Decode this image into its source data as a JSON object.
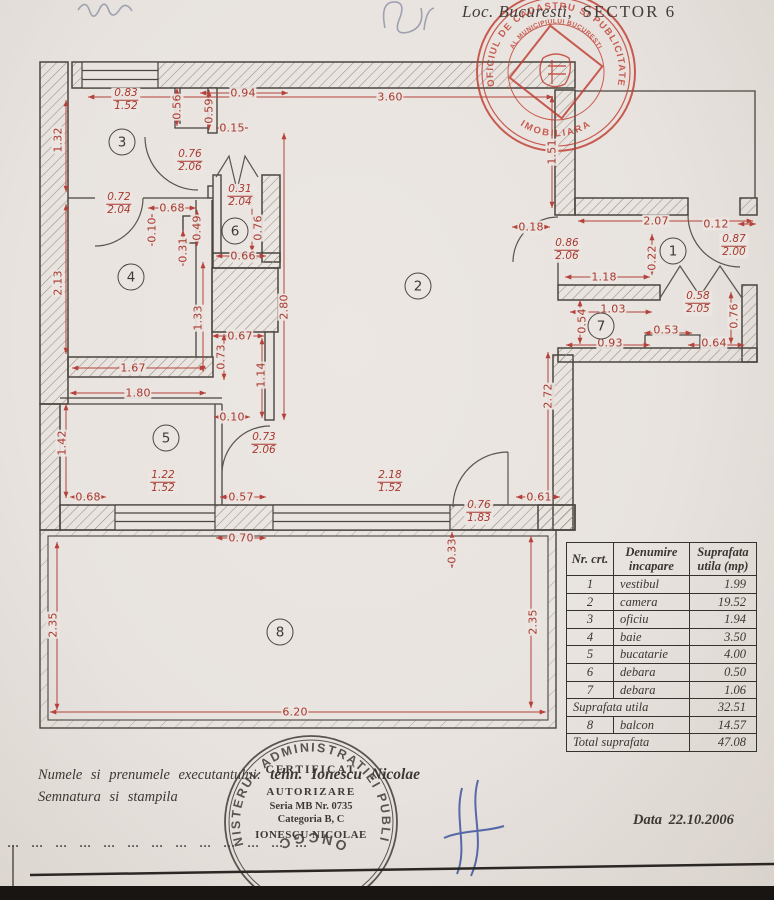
{
  "page": {
    "location_prefix": "Loc. Bucuresti,",
    "location_sector": "SECTOR 6",
    "date_line": "Data 22.10.2006"
  },
  "red_stamp": {
    "ring_top": "OFICIUL DE CADASTRU SI PUBLICITATE",
    "ring_bottom": "IMOBILIARA",
    "ring_inner": "AL MUNICIPIULUI BUCURESTI"
  },
  "round_stamp": {
    "ring_top": "MINISTERUL ADMINISTRATIEI PUBLICE",
    "ring_bottom": "ONCGC",
    "center_lines": [
      "CERTIFICAT",
      "AUTORIZARE",
      "Seria MB Nr. 0735",
      "Categoria B, C",
      "IONESCU NICOLAE"
    ]
  },
  "footer": {
    "line1_label": "Numele si prenumele executantului:",
    "line1_value": "tehn. Ionescu Nicolae",
    "line2": "Semnatura si stampila",
    "dotted_line": "... ... ... ... ... ... ... ... ... ... ... ... ..."
  },
  "table": {
    "headers": [
      "Nr. crt.",
      "Denumire incapare",
      "Suprafata utila (mp)"
    ],
    "rows": [
      {
        "nr": "1",
        "name": "vestibul",
        "val": "1.99",
        "merged": false
      },
      {
        "nr": "2",
        "name": "camera",
        "val": "19.52",
        "merged": false
      },
      {
        "nr": "3",
        "name": "oficiu",
        "val": "1.94",
        "merged": false
      },
      {
        "nr": "4",
        "name": "baie",
        "val": "3.50",
        "merged": false
      },
      {
        "nr": "5",
        "name": "bucatarie",
        "val": "4.00",
        "merged": false
      },
      {
        "nr": "6",
        "name": "debara",
        "val": "0.50",
        "merged": false
      },
      {
        "nr": "7",
        "name": "debara",
        "val": "1.06",
        "merged": false
      },
      {
        "nr": "",
        "name": "Suprafata utila",
        "val": "32.51",
        "merged": true
      },
      {
        "nr": "8",
        "name": "balcon",
        "val": "14.57",
        "merged": false
      },
      {
        "nr": "",
        "name": "Total suprafata",
        "val": "47.08",
        "merged": true
      }
    ]
  },
  "plan": {
    "rooms": [
      {
        "n": "1",
        "x": 673,
        "y": 251
      },
      {
        "n": "2",
        "x": 418,
        "y": 286
      },
      {
        "n": "3",
        "x": 122,
        "y": 142
      },
      {
        "n": "4",
        "x": 131,
        "y": 277
      },
      {
        "n": "5",
        "x": 166,
        "y": 438
      },
      {
        "n": "6",
        "x": 235,
        "y": 231
      },
      {
        "n": "7",
        "x": 601,
        "y": 326
      },
      {
        "n": "8",
        "x": 280,
        "y": 632
      }
    ],
    "dims": [
      {
        "t": "3.60",
        "x": 390,
        "y": 97,
        "r": 0
      },
      {
        "t": "0.94",
        "x": 243,
        "y": 93,
        "r": 0
      },
      {
        "t": "0.15",
        "x": 232,
        "y": 128,
        "r": 0
      },
      {
        "t": "0.68",
        "x": 172,
        "y": 208,
        "r": 0
      },
      {
        "t": "0.66",
        "x": 243,
        "y": 256,
        "r": 0
      },
      {
        "t": "0.67",
        "x": 240,
        "y": 336,
        "r": 0
      },
      {
        "t": "1.67",
        "x": 133,
        "y": 368,
        "r": 0
      },
      {
        "t": "1.80",
        "x": 138,
        "y": 393,
        "r": 0
      },
      {
        "t": "0.10",
        "x": 232,
        "y": 417,
        "r": 0
      },
      {
        "t": "0.68",
        "x": 88,
        "y": 497,
        "r": 0
      },
      {
        "t": "0.57",
        "x": 241,
        "y": 497,
        "r": 0
      },
      {
        "t": "0.61",
        "x": 539,
        "y": 497,
        "r": 0
      },
      {
        "t": "0.70",
        "x": 241,
        "y": 538,
        "r": 0
      },
      {
        "t": "6.20",
        "x": 295,
        "y": 712,
        "r": 0
      },
      {
        "t": "2.07",
        "x": 656,
        "y": 221,
        "r": 0
      },
      {
        "t": "0.18",
        "x": 531,
        "y": 227,
        "r": 0
      },
      {
        "t": "0.12",
        "x": 716,
        "y": 224,
        "r": 0
      },
      {
        "t": "1.18",
        "x": 604,
        "y": 277,
        "r": 0
      },
      {
        "t": "1.03",
        "x": 613,
        "y": 309,
        "r": 0
      },
      {
        "t": "0.93",
        "x": 610,
        "y": 343,
        "r": 0
      },
      {
        "t": "0.53",
        "x": 666,
        "y": 330,
        "r": 0
      },
      {
        "t": "0.64",
        "x": 714,
        "y": 343,
        "r": 0
      },
      {
        "t": "1.32",
        "x": 58,
        "y": 140,
        "r": 1
      },
      {
        "t": "0.56",
        "x": 177,
        "y": 107,
        "r": 1
      },
      {
        "t": "0.59",
        "x": 209,
        "y": 111,
        "r": 1
      },
      {
        "t": "2.13",
        "x": 58,
        "y": 283,
        "r": 1
      },
      {
        "t": "0.10",
        "x": 152,
        "y": 230,
        "r": 1
      },
      {
        "t": "0.49",
        "x": 197,
        "y": 228,
        "r": 1
      },
      {
        "t": "0.31",
        "x": 183,
        "y": 250,
        "r": 1
      },
      {
        "t": "0.76",
        "x": 258,
        "y": 228,
        "r": 1
      },
      {
        "t": "2.80",
        "x": 284,
        "y": 307,
        "r": 1
      },
      {
        "t": "1.33",
        "x": 198,
        "y": 318,
        "r": 1
      },
      {
        "t": "0.73",
        "x": 221,
        "y": 357,
        "r": 1
      },
      {
        "t": "1.14",
        "x": 261,
        "y": 375,
        "r": 1
      },
      {
        "t": "1.42",
        "x": 62,
        "y": 443,
        "r": 1
      },
      {
        "t": "1.51",
        "x": 552,
        "y": 152,
        "r": 1
      },
      {
        "t": "0.22",
        "x": 652,
        "y": 258,
        "r": 1
      },
      {
        "t": "0.54",
        "x": 582,
        "y": 321,
        "r": 1
      },
      {
        "t": "0.76",
        "x": 734,
        "y": 316,
        "r": 1
      },
      {
        "t": "2.72",
        "x": 548,
        "y": 396,
        "r": 1
      },
      {
        "t": "0.33",
        "x": 452,
        "y": 551,
        "r": 1
      },
      {
        "t": "2.35",
        "x": 53,
        "y": 625,
        "r": 1
      },
      {
        "t": "2.35",
        "x": 533,
        "y": 622,
        "r": 1
      }
    ],
    "fracs": [
      {
        "a": "0.83",
        "b": "1.52",
        "x": 126,
        "y": 100
      },
      {
        "a": "0.76",
        "b": "2.06",
        "x": 190,
        "y": 161
      },
      {
        "a": "0.72",
        "b": "2.04",
        "x": 119,
        "y": 204
      },
      {
        "a": "0.31",
        "b": "2.04",
        "x": 240,
        "y": 196
      },
      {
        "a": "0.86",
        "b": "2.06",
        "x": 567,
        "y": 250
      },
      {
        "a": "0.87",
        "b": "2.00",
        "x": 734,
        "y": 246
      },
      {
        "a": "0.58",
        "b": "2.05",
        "x": 698,
        "y": 303
      },
      {
        "a": "0.73",
        "b": "2.06",
        "x": 264,
        "y": 444
      },
      {
        "a": "1.22",
        "b": "1.52",
        "x": 163,
        "y": 482
      },
      {
        "a": "2.18",
        "b": "1.52",
        "x": 390,
        "y": 482
      },
      {
        "a": "0.76",
        "b": "1.83",
        "x": 479,
        "y": 512
      }
    ]
  }
}
